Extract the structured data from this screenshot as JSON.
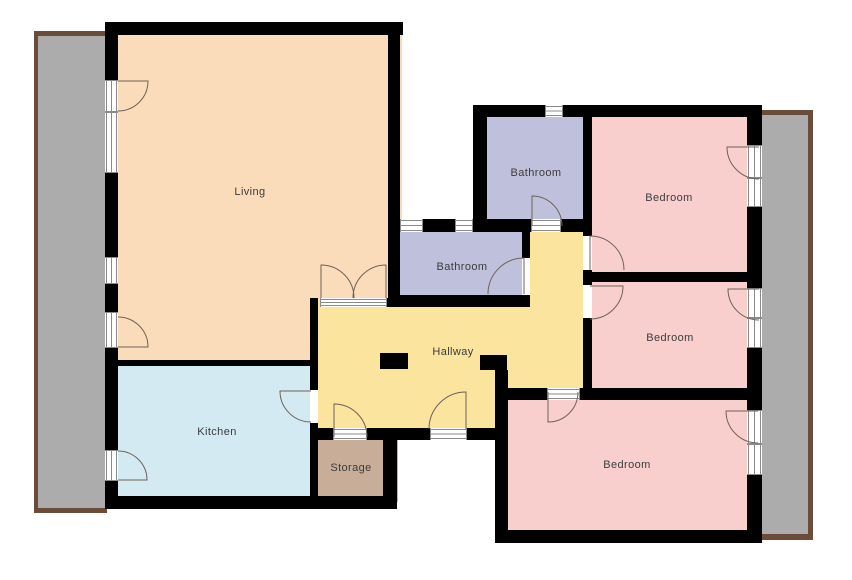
{
  "title": "Apartment floor plan",
  "canvas": {
    "width": 852,
    "height": 580
  },
  "colors": {
    "background": "#ffffff",
    "wall": "#000000",
    "living": "#FBDCBA",
    "kitchen": "#D3EAF2",
    "bedroom": "#F9CFCD",
    "bathroom": "#BFC0DB",
    "hallway": "#FAE49E",
    "storage": "#C8AE99",
    "balcony_fill": "#ACACAC",
    "balcony_border": "#6B4B3A",
    "door_stroke": "#6f6258",
    "frame_stroke": "#8a8a8a",
    "label_text": "#3c3c3c"
  },
  "label_font_px": 11,
  "balconies": [
    {
      "id": "balcony-left",
      "outer": [
        34,
        31,
        73,
        482
      ],
      "inner": [
        38,
        36,
        69,
        472
      ]
    },
    {
      "id": "balcony-right",
      "outer": [
        762,
        110,
        51,
        430
      ],
      "inner": [
        762,
        115,
        46,
        419
      ]
    }
  ],
  "rooms": [
    {
      "id": "living",
      "label": "Living",
      "color_key": "living",
      "label_xy": [
        250,
        191
      ],
      "rects": [
        [
          110,
          28,
          292,
          280
        ],
        [
          110,
          300,
          207,
          65
        ]
      ]
    },
    {
      "id": "kitchen",
      "label": "Kitchen",
      "color_key": "kitchen",
      "label_xy": [
        217,
        431
      ],
      "rects": [
        [
          110,
          362,
          207,
          140
        ]
      ]
    },
    {
      "id": "storage",
      "label": "Storage",
      "color_key": "storage",
      "label_xy": [
        351,
        467
      ],
      "rects": [
        [
          310,
          430,
          88,
          72
        ]
      ]
    },
    {
      "id": "hallway",
      "label": "Hallway",
      "color_key": "hallway",
      "label_xy": [
        453,
        351
      ],
      "rects": [
        [
          316,
          298,
          270,
          96
        ],
        [
          526,
          224,
          60,
          80
        ],
        [
          314,
          390,
          185,
          42
        ]
      ]
    },
    {
      "id": "bathroom-top",
      "label": "Bathroom",
      "color_key": "bathroom",
      "label_xy": [
        536,
        172
      ],
      "rects": [
        [
          478,
          110,
          110,
          116
        ]
      ]
    },
    {
      "id": "bathroom-mid",
      "label": "Bathroom",
      "color_key": "bathroom",
      "label_xy": [
        462,
        266
      ],
      "rects": [
        [
          394,
          222,
          136,
          80
        ]
      ]
    },
    {
      "id": "bedroom-top",
      "label": "Bedroom",
      "color_key": "bedroom",
      "label_xy": [
        669,
        197
      ],
      "rects": [
        [
          586,
          115,
          176,
          170
        ]
      ]
    },
    {
      "id": "bedroom-mid",
      "label": "Bedroom",
      "color_key": "bedroom",
      "label_xy": [
        670,
        337
      ],
      "rects": [
        [
          586,
          278,
          176,
          118
        ]
      ]
    },
    {
      "id": "bedroom-bottom",
      "label": "Bedroom",
      "color_key": "bedroom",
      "label_xy": [
        627,
        464
      ],
      "rects": [
        [
          500,
          392,
          262,
          145
        ]
      ]
    }
  ],
  "walls": [
    [
      105,
      22,
      298,
      13
    ],
    [
      473,
      105,
      72,
      12
    ],
    [
      563,
      105,
      199,
      12
    ],
    [
      105,
      22,
      13,
      58
    ],
    [
      105,
      173,
      13,
      84
    ],
    [
      105,
      284,
      13,
      28
    ],
    [
      105,
      348,
      13,
      102
    ],
    [
      105,
      481,
      13,
      28
    ],
    [
      388,
      22,
      12,
      285
    ],
    [
      423,
      219,
      32,
      13
    ],
    [
      473,
      219,
      58,
      13
    ],
    [
      561,
      219,
      31,
      13
    ],
    [
      473,
      117,
      14,
      102
    ],
    [
      583,
      117,
      9,
      119
    ],
    [
      583,
      270,
      9,
      15
    ],
    [
      583,
      318,
      9,
      70
    ],
    [
      592,
      272,
      170,
      10
    ],
    [
      495,
      388,
      52,
      12
    ],
    [
      580,
      388,
      182,
      12
    ],
    [
      747,
      117,
      15,
      28
    ],
    [
      747,
      207,
      15,
      81
    ],
    [
      747,
      348,
      15,
      62
    ],
    [
      747,
      475,
      15,
      68
    ],
    [
      495,
      400,
      13,
      143
    ],
    [
      495,
      530,
      267,
      13
    ],
    [
      312,
      428,
      21,
      12
    ],
    [
      367,
      428,
      63,
      12
    ],
    [
      467,
      428,
      30,
      12
    ],
    [
      383,
      428,
      14,
      81
    ],
    [
      105,
      496,
      292,
      13
    ],
    [
      310,
      298,
      8,
      92
    ],
    [
      310,
      423,
      8,
      73
    ],
    [
      387,
      298,
      13,
      9
    ],
    [
      105,
      360,
      210,
      6
    ],
    [
      480,
      355,
      27,
      15
    ],
    [
      495,
      370,
      13,
      30
    ],
    [
      380,
      353,
      28,
      16
    ],
    [
      522,
      232,
      8,
      26
    ],
    [
      400,
      295,
      130,
      12
    ]
  ],
  "openings": [
    {
      "id": "living-balcony-door-upper",
      "r": [
        105,
        80,
        13,
        32
      ],
      "o": "v",
      "framed": true
    },
    {
      "id": "living-window-upper",
      "r": [
        105,
        112,
        13,
        61
      ],
      "o": "v",
      "framed": true
    },
    {
      "id": "living-window-lower",
      "r": [
        105,
        257,
        13,
        27
      ],
      "o": "v",
      "framed": true
    },
    {
      "id": "living-balcony-door-lower",
      "r": [
        105,
        312,
        13,
        36
      ],
      "o": "v",
      "framed": true
    },
    {
      "id": "kitchen-balcony-door",
      "r": [
        105,
        450,
        13,
        31
      ],
      "o": "v",
      "framed": true
    },
    {
      "id": "bathroom-mid-window-left",
      "r": [
        400,
        219,
        23,
        13
      ],
      "o": "h",
      "framed": true
    },
    {
      "id": "bathroom-mid-window-right",
      "r": [
        455,
        219,
        18,
        13
      ],
      "o": "h",
      "framed": true
    },
    {
      "id": "bathroom-top-window",
      "r": [
        545,
        105,
        18,
        12
      ],
      "o": "h",
      "framed": true
    },
    {
      "id": "bedroom-top-balcony-door",
      "r": [
        747,
        145,
        15,
        33
      ],
      "o": "v",
      "framed": true
    },
    {
      "id": "bedroom-top-window",
      "r": [
        747,
        178,
        15,
        29
      ],
      "o": "v",
      "framed": true
    },
    {
      "id": "bedroom-mid-balcony-door",
      "r": [
        747,
        288,
        15,
        30
      ],
      "o": "v",
      "framed": true
    },
    {
      "id": "bedroom-mid-window",
      "r": [
        747,
        318,
        15,
        30
      ],
      "o": "v",
      "framed": true
    },
    {
      "id": "bedroom-bottom-balcony-door",
      "r": [
        747,
        410,
        15,
        34
      ],
      "o": "v",
      "framed": true
    },
    {
      "id": "bedroom-bottom-window",
      "r": [
        747,
        444,
        15,
        31
      ],
      "o": "v",
      "framed": true
    },
    {
      "id": "bathroom-top-doorway",
      "r": [
        531,
        219,
        30,
        13
      ],
      "o": "h",
      "framed": true
    },
    {
      "id": "bathroom-mid-doorway",
      "r": [
        522,
        258,
        8,
        37
      ],
      "o": "v",
      "framed": false
    },
    {
      "id": "bedroom-top-doorway",
      "r": [
        583,
        236,
        9,
        34
      ],
      "o": "v",
      "framed": false
    },
    {
      "id": "bedroom-mid-doorway",
      "r": [
        583,
        285,
        9,
        33
      ],
      "o": "v",
      "framed": false
    },
    {
      "id": "bedroom-bottom-doorway",
      "r": [
        547,
        388,
        33,
        12
      ],
      "o": "h",
      "framed": true
    },
    {
      "id": "living-double-doorway",
      "r": [
        320,
        298,
        67,
        9
      ],
      "o": "h",
      "framed": true
    },
    {
      "id": "kitchen-doorway",
      "r": [
        310,
        390,
        8,
        33
      ],
      "o": "v",
      "framed": false
    },
    {
      "id": "storage-doorway",
      "r": [
        333,
        428,
        34,
        12
      ],
      "o": "h",
      "framed": true
    },
    {
      "id": "entrance-doorway",
      "r": [
        430,
        428,
        37,
        12
      ],
      "o": "h",
      "framed": true
    }
  ],
  "door_swings": [
    {
      "id": "living-balcony-door-upper-swing",
      "path": "M118,81 L148,81 A30,30 0 0 1 118,111"
    },
    {
      "id": "living-balcony-door-lower-swing",
      "path": "M118,347 L148,347 A30,30 0 0 0 118,317"
    },
    {
      "id": "kitchen-balcony-door-swing",
      "path": "M118,480 L147,480 A29,29 0 0 0 118,451"
    },
    {
      "id": "kitchen-door-swing",
      "path": "M311,391 L280,391 A31,31 0 0 0 311,422"
    },
    {
      "id": "storage-door-swing",
      "path": "M334,437 L334,404 A33,33 0 0 1 367,437"
    },
    {
      "id": "entrance-door-swing",
      "path": "M466,429 L466,392 A37,37 0 0 0 429,429"
    },
    {
      "id": "living-double-door-left-swing",
      "path": "M321,298 L321,265 A33,33 0 0 1 354,298"
    },
    {
      "id": "living-double-door-right-swing",
      "path": "M386,298 L386,265 A33,33 0 0 0 353,298"
    },
    {
      "id": "bathroom-mid-door-swing",
      "path": "M524,294 L524,258 A36,36 0 0 0 488,294"
    },
    {
      "id": "bathroom-top-door-swing",
      "path": "M532,226 L532,196 A30,30 0 0 1 562,226"
    },
    {
      "id": "bedroom-top-door-swing",
      "path": "M590,270 L590,236 A34,34 0 0 1 624,270"
    },
    {
      "id": "bedroom-mid-door-swing",
      "path": "M590,286 L623,286 A33,33 0 0 1 590,319"
    },
    {
      "id": "bedroom-top-balcony-door-swing",
      "path": "M759,147 L727,147 A32,32 0 0 0 759,179"
    },
    {
      "id": "bedroom-mid-balcony-door-swing",
      "path": "M759,289 L728,289 A31,31 0 0 0 759,320"
    },
    {
      "id": "bedroom-bottom-balcony-door-swing",
      "path": "M758,411 L726,411 A32,32 0 0 0 758,443"
    },
    {
      "id": "bedroom-bottom-door-swing",
      "path": "M548,392 L548,422 A30,30 0 0 0 578,392"
    }
  ]
}
